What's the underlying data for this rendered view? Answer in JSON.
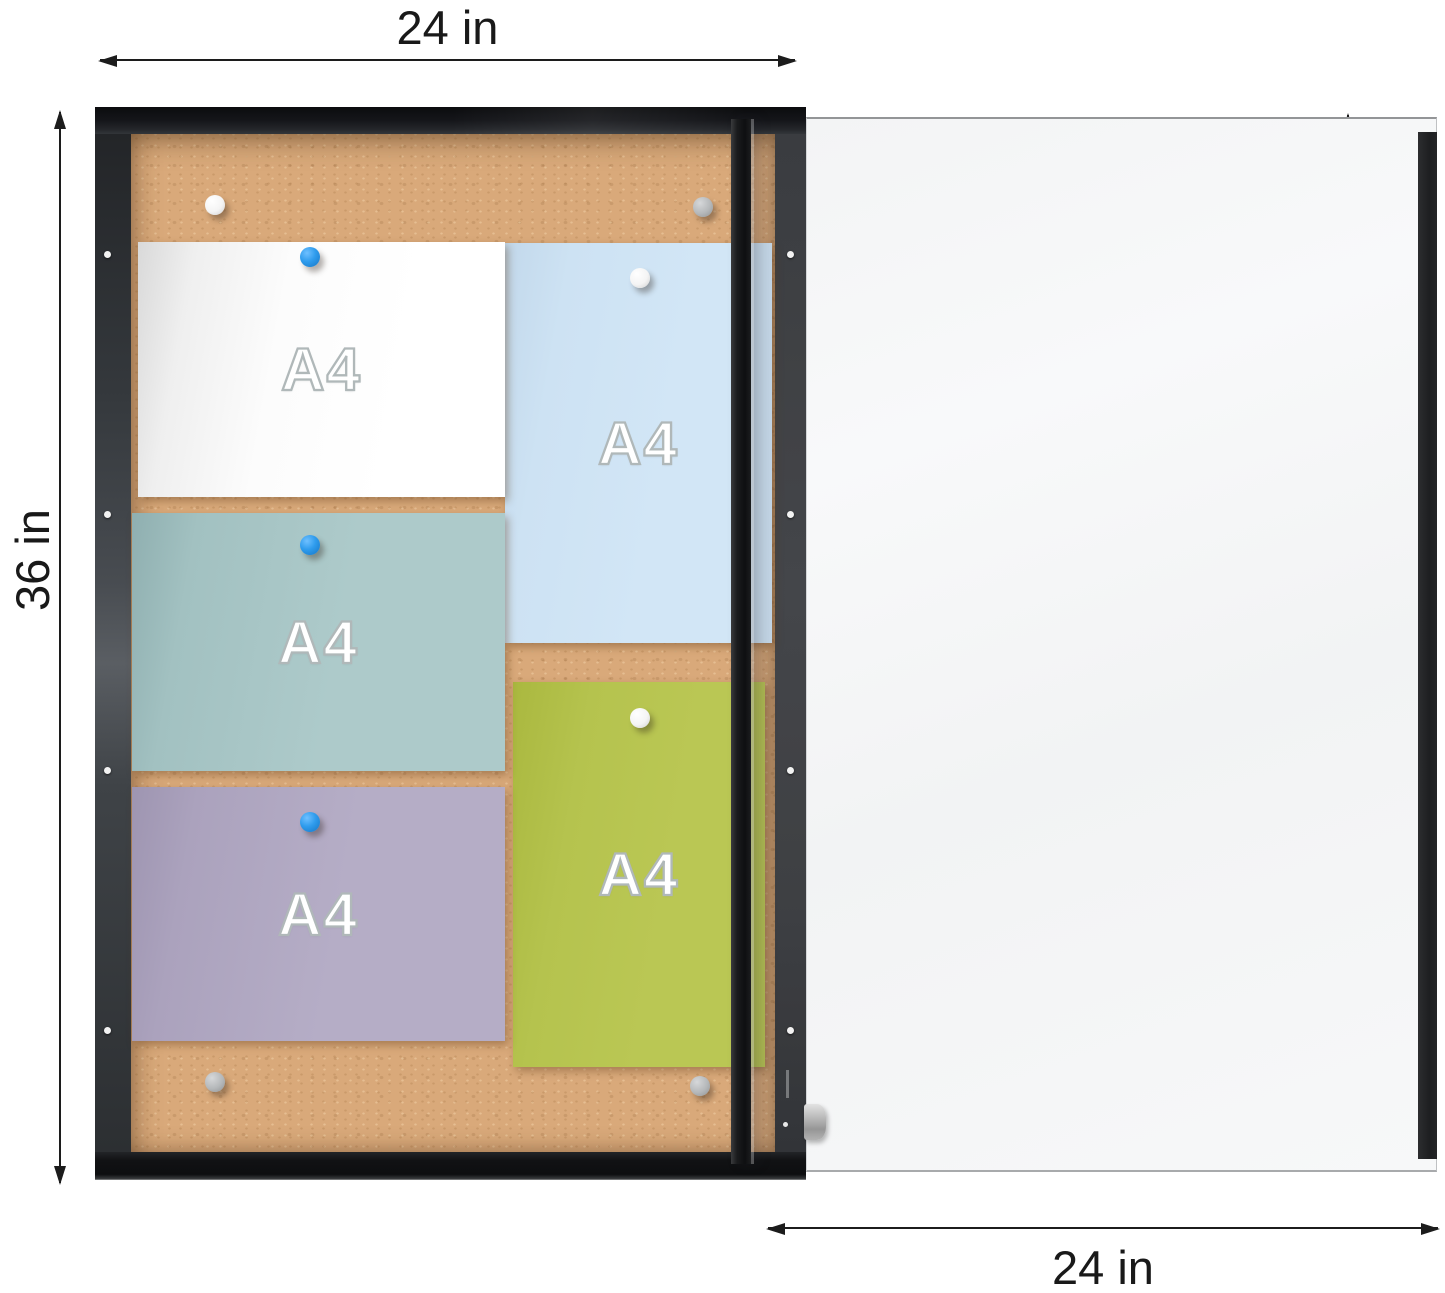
{
  "dims": {
    "top": {
      "label": "24 in"
    },
    "left": {
      "label": "36 in"
    },
    "right": {
      "label": "36 in"
    },
    "bottom": {
      "label": "24 in"
    }
  },
  "cabinet": {
    "frame_color": "#17191c",
    "cork_color": "#d9a97a",
    "papers": [
      {
        "name": "white-a4",
        "label": "A4",
        "color": "#ffffff",
        "orientation": "landscape"
      },
      {
        "name": "blue-a4",
        "label": "A4",
        "color": "#cfe3f4",
        "orientation": "portrait"
      },
      {
        "name": "teal-a4",
        "label": "A4",
        "color": "#a9c7c7",
        "orientation": "landscape"
      },
      {
        "name": "green-a4",
        "label": "A4",
        "color": "#b7c452",
        "orientation": "portrait"
      },
      {
        "name": "lavender-a4",
        "label": "A4",
        "color": "#b2aac3",
        "orientation": "landscape"
      }
    ],
    "pins": [
      {
        "name": "pin-white-cork-top-left",
        "color": "#ffffff"
      },
      {
        "name": "pin-gray-cork-top-right",
        "color": "#b5b8ba"
      },
      {
        "name": "pin-blue-on-white-paper",
        "color": "#2f9ced"
      },
      {
        "name": "pin-white-on-blue-paper",
        "color": "#ffffff"
      },
      {
        "name": "pin-blue-on-teal-paper",
        "color": "#2f9ced"
      },
      {
        "name": "pin-white-on-green-paper",
        "color": "#ffffff"
      },
      {
        "name": "pin-blue-on-lavender-paper",
        "color": "#2f9ced"
      },
      {
        "name": "pin-gray-cork-bottom-left",
        "color": "#b5b8ba"
      },
      {
        "name": "pin-gray-cork-bottom-right",
        "color": "#b5b8ba"
      }
    ]
  },
  "door": {
    "glass_color": "#f5f6f7",
    "handle_color": "#232426",
    "knob_color": "#bbbbbb"
  }
}
